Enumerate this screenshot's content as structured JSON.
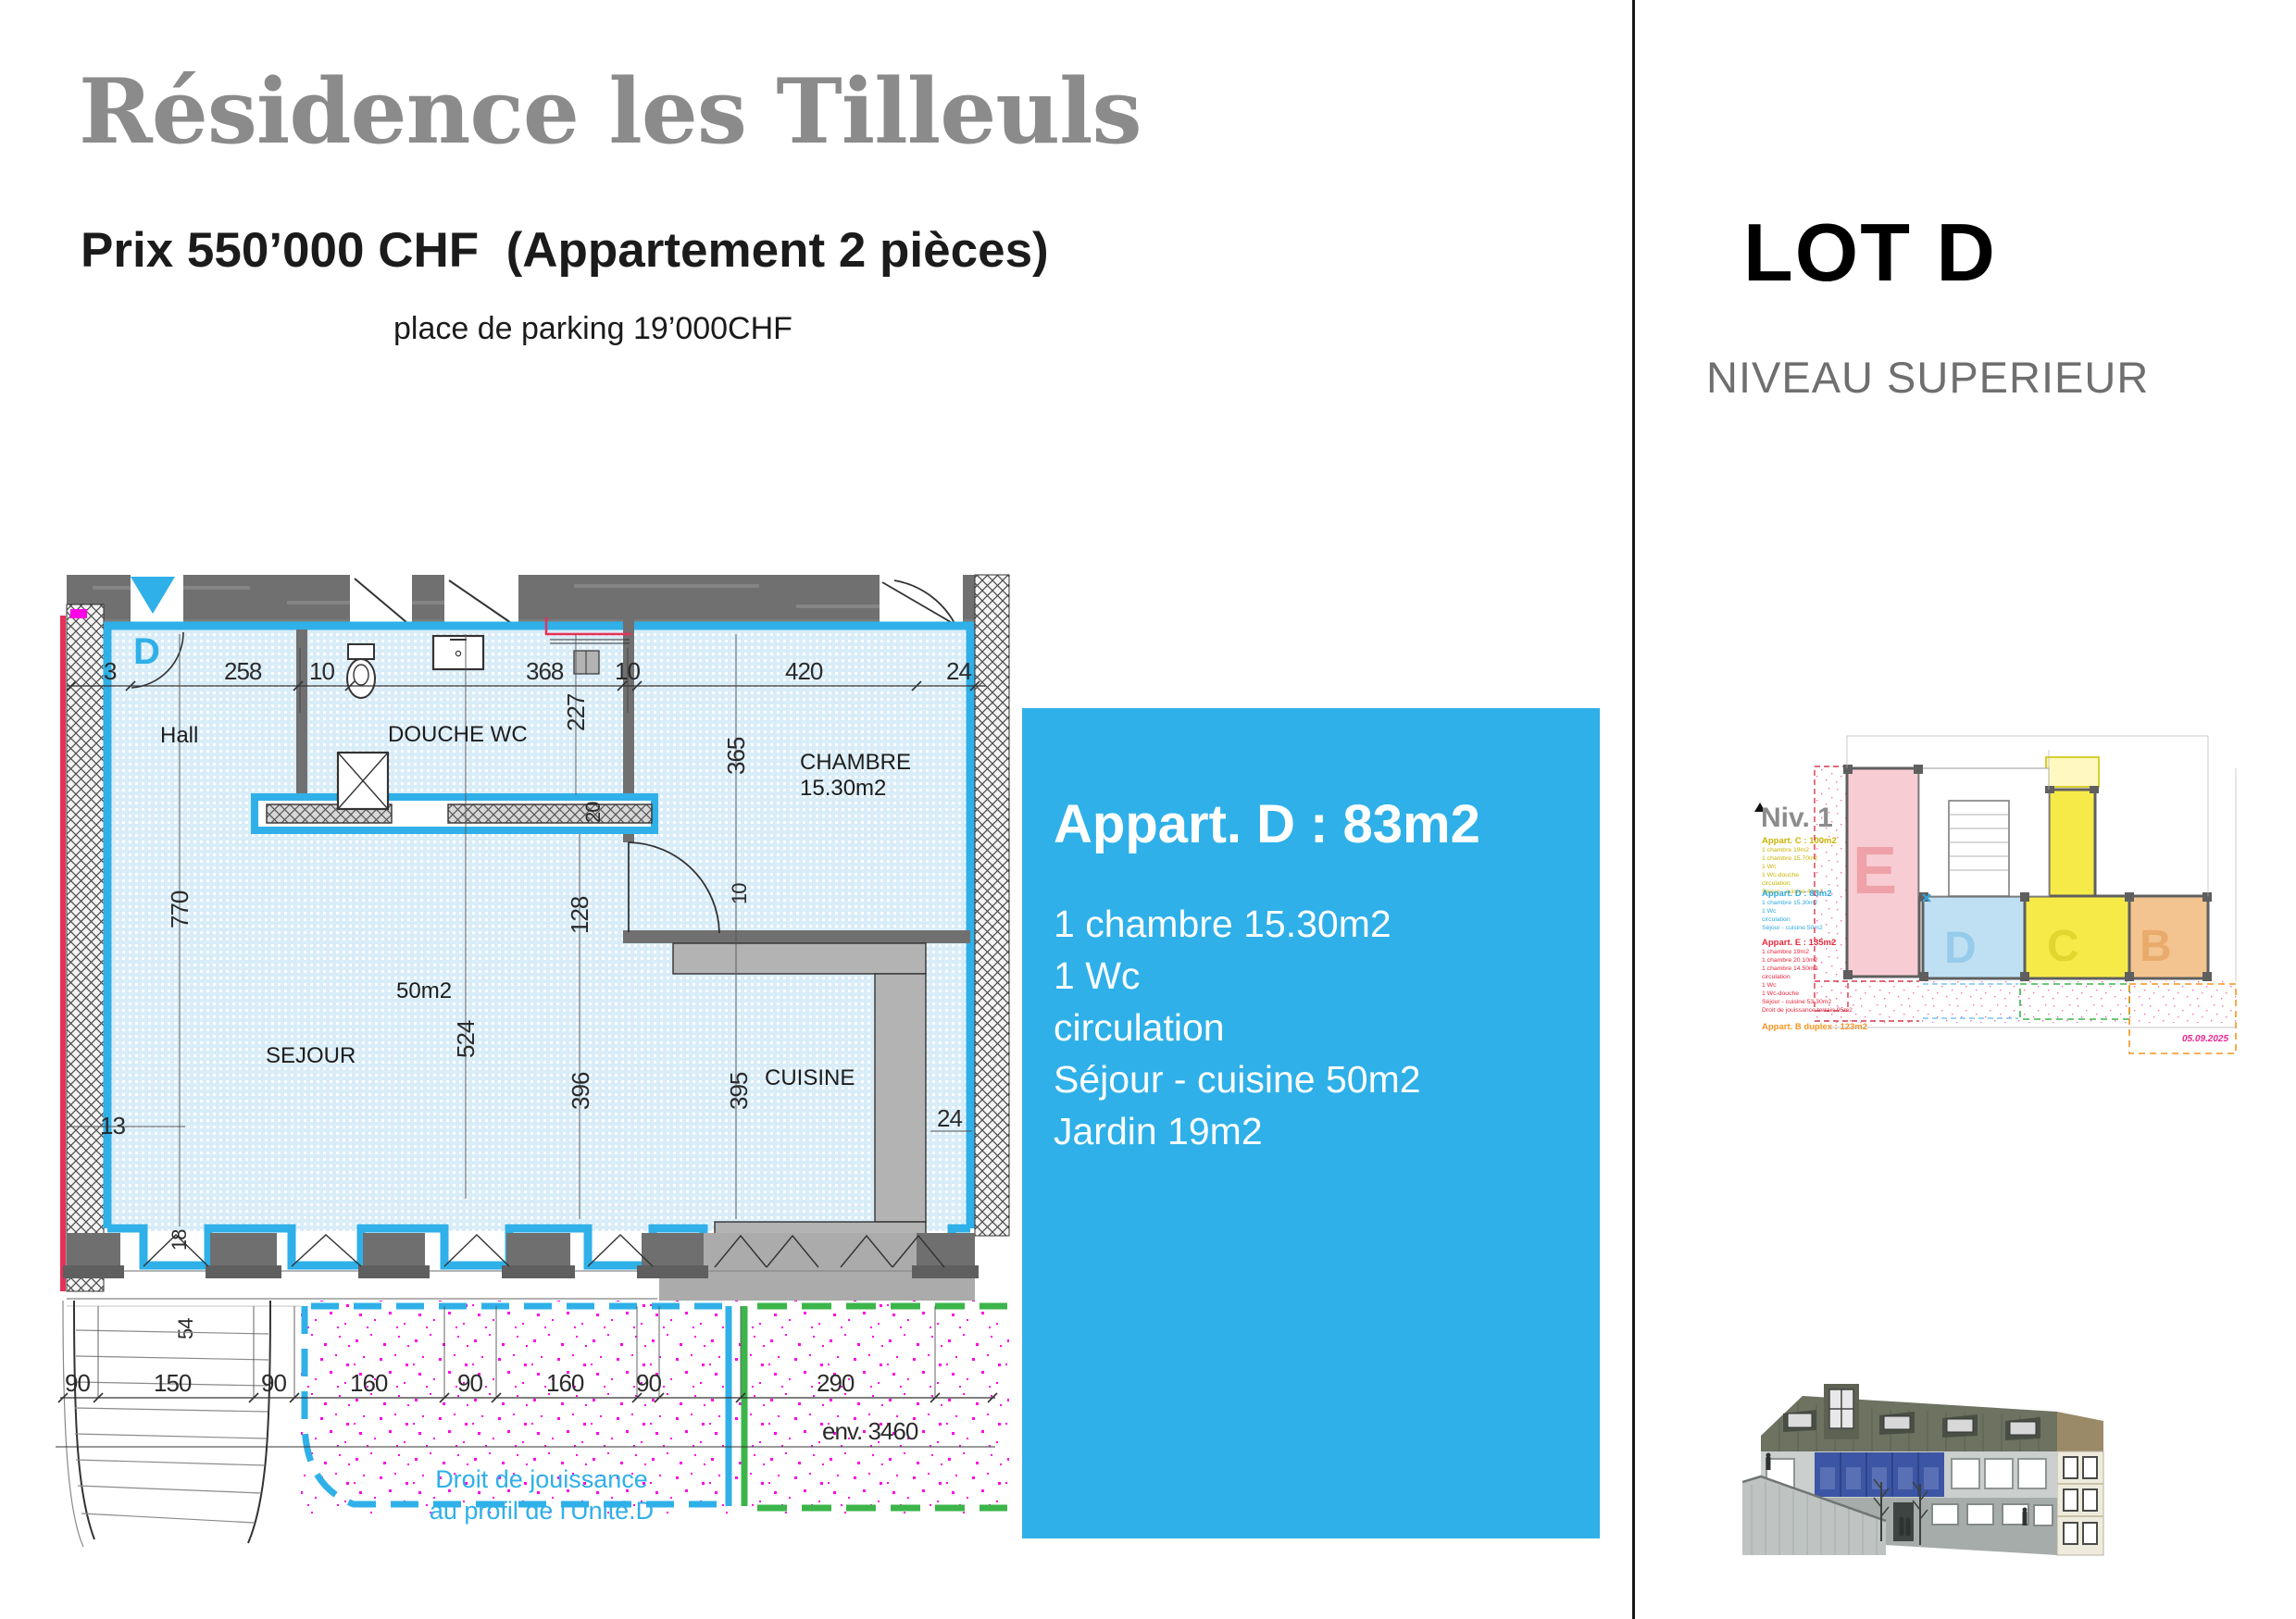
{
  "header": {
    "title": "Résidence les Tilleuls",
    "price_line": "Prix 550’000 CHF  (Appartement 2 pièces)",
    "parking_line": "place de parking 19’000CHF"
  },
  "info_box": {
    "title": "Appart. D : 83m2",
    "lines": [
      "1 chambre 15.30m2",
      "1 Wc",
      "circulation",
      "Séjour - cuisine 50m2",
      "Jardin 19m2"
    ],
    "bg_color": "#2fb0e8"
  },
  "right_panel": {
    "lot_title": "LOT D",
    "level_subtitle": "NIVEAU SUPERIEUR",
    "site_plan": {
      "level_label": "Niv. 1",
      "date": "05.09.2025",
      "apartments": [
        {
          "key": "C",
          "name": "Appart. C : 100m2",
          "color": "#c8b400",
          "details": [
            "1 chambre 19m2",
            "1 chambre 15.70m2",
            "1 Wc",
            "1 Wc-douche",
            "circulation",
            "Séjour - cuisine 42m2"
          ]
        },
        {
          "key": "D",
          "name": "Appart. D : 83m2",
          "color": "#2fa8e0",
          "details": [
            "1 chambre 15.30m2",
            "1 Wc",
            "circulation",
            "Séjour - cuisine 50m2"
          ]
        },
        {
          "key": "E",
          "name": "Appart. E : 135m2",
          "color": "#e8273b",
          "details": [
            "1 chambre 19m2",
            "1 chambre 20.10m2",
            "1 chambre 14.50m2",
            "circulation",
            "1 Wc",
            "1 Wc-douche",
            "Séjour - cuisine 53.30m2",
            "Droit de jouissance terrain 95m2"
          ]
        },
        {
          "key": "B",
          "name": "Appart. B duplex : 123m2",
          "color": "#f7941d",
          "details": []
        }
      ],
      "letters": {
        "E": "E",
        "D": "D",
        "C": "C",
        "B": "B"
      }
    }
  },
  "floor_plan": {
    "unit_letter": "D",
    "rooms": {
      "hall": "Hall",
      "douche": "DOUCHE WC",
      "chambre_name": "CHAMBRE",
      "chambre_area": "15.30m2",
      "sejour": "SEJOUR",
      "sejour_area": "50m2",
      "cuisine": "CUISINE"
    },
    "dims": {
      "top": [
        "3",
        "258",
        "10",
        "368",
        "10",
        "420",
        "24"
      ],
      "v227": "227",
      "v365": "365",
      "v770": "770",
      "v524": "524",
      "v128": "128",
      "v396": "396",
      "v395": "395",
      "s20": "20",
      "s10": "10",
      "s24": "24",
      "s13": "13",
      "s18": "18",
      "s54": "54",
      "garden": [
        "90",
        "150",
        "90",
        "160",
        "90",
        "160",
        "90",
        "290"
      ],
      "env": "env. 3460"
    },
    "garden_note_line1": "Droit de jouissance",
    "garden_note_line2": "au profil de l'Unité.D",
    "colors": {
      "accent_blue": "#2fb0e8",
      "plan_fill": "#d9edf8",
      "wall_gray": "#6f6f6f",
      "counter_gray": "#b3b3b3",
      "magenta": "#ff00e6",
      "green": "#3cb54a",
      "red_line": "#e73059"
    }
  }
}
